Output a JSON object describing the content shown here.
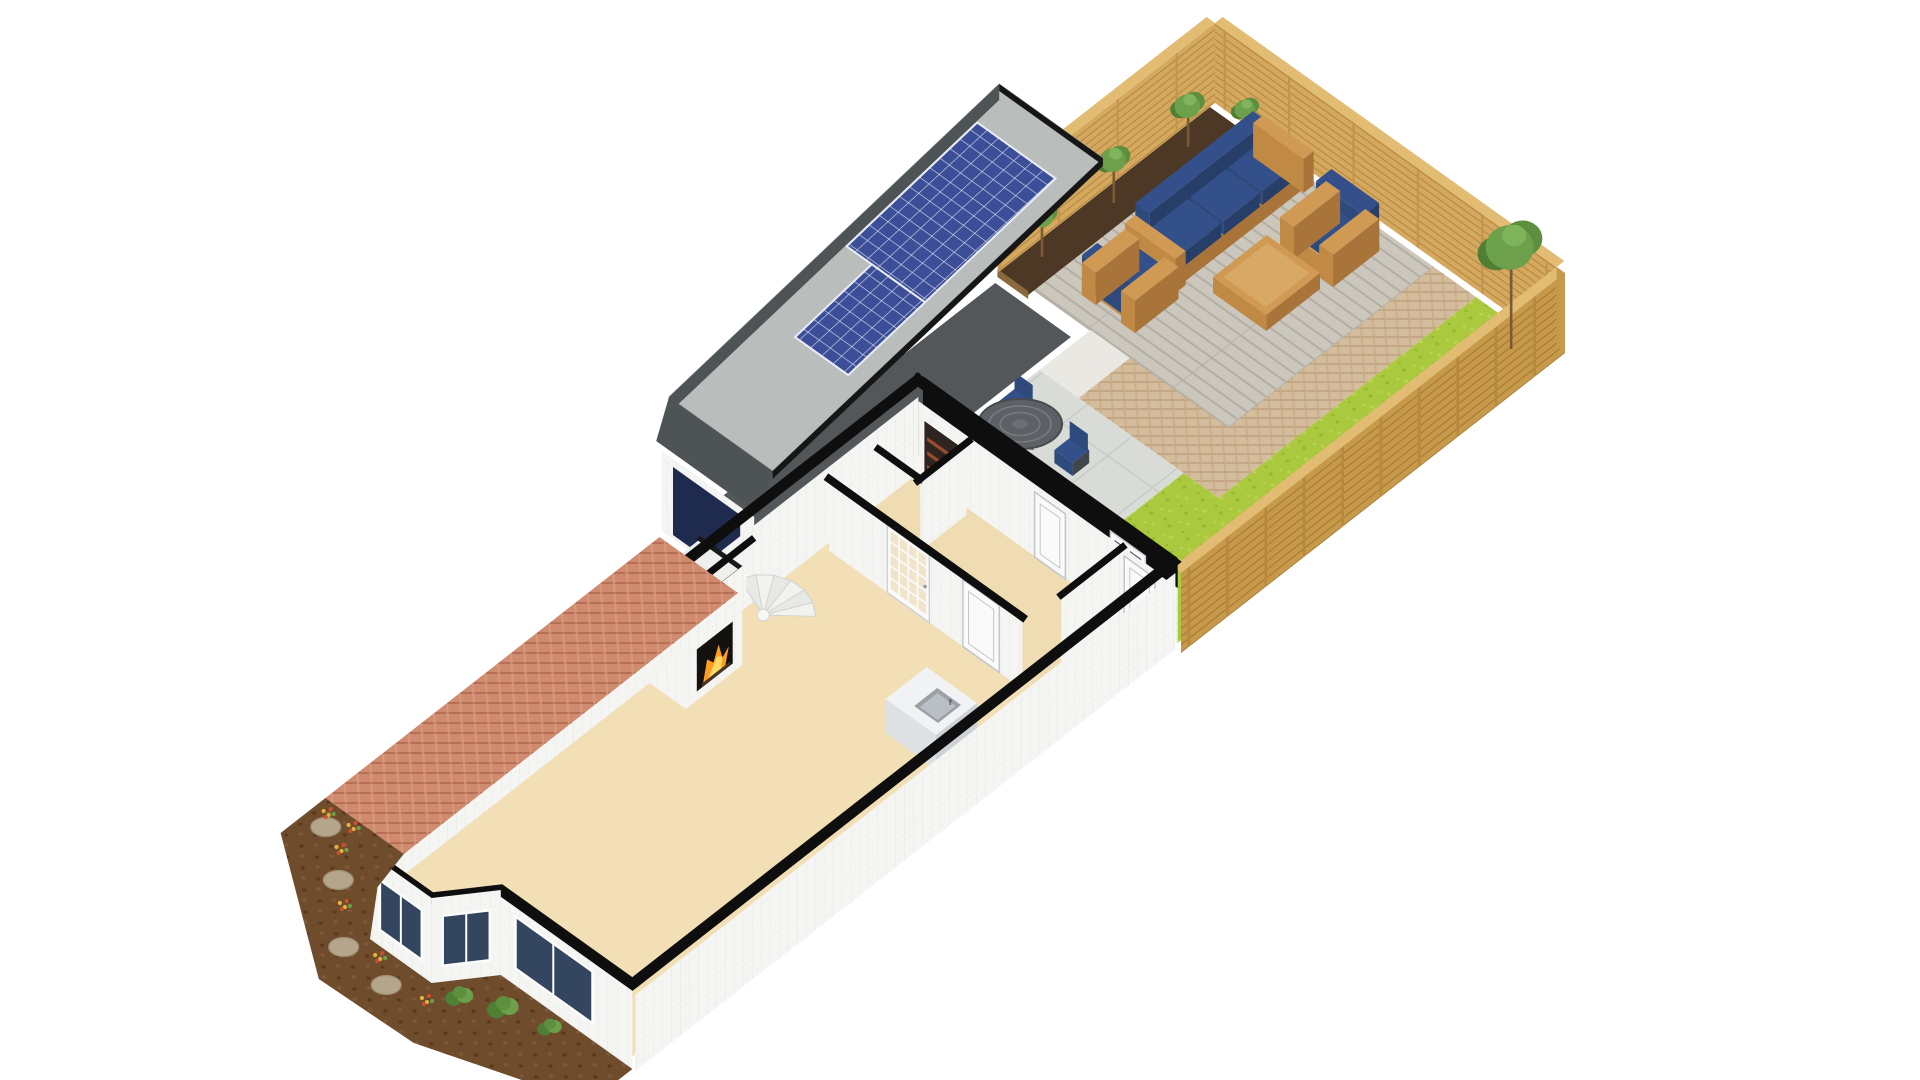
{
  "page": {
    "background": "#ffffff",
    "kind": "3d-floorplan-render"
  },
  "colors": {
    "bg": "#ffffff",
    "cutWall": "#0e0e0e",
    "wallWhite": "#f5f6f3",
    "wallShade": "#e3e6e4",
    "wallInner": "#eceeee",
    "floorBeige": "#f2dfb6",
    "floorBeigeHall": "#efdcb2",
    "garageFloor": "#54575a",
    "garageDoor": "#1e2a4e",
    "roofGrey": "#b9bdbb",
    "roofEdge": "#161616",
    "roofFascia": "#4e5356",
    "solarBlue": "#3c4e97",
    "solarLine": "#d9def0",
    "deck": "#cbc7bd",
    "deckLine": "#b2aea4",
    "pathTan": "#d4bd9d",
    "pathTanLine": "#bfa07c",
    "paveGrey": "#d9dbd7",
    "paveLine": "#c3c6c1",
    "gravel": "#e9e8e2",
    "lawn": "#abc93e",
    "lawnDot": "#97b72e",
    "lawnDot2": "#bad355",
    "soilDark": "#4c3824",
    "soilBed": "#6f4c2c",
    "soilBedDot": "#5a3a1e",
    "brick": "#d08a6e",
    "brickLine": "#b26a50",
    "woodFence": "#d4a85e",
    "woodFenceDark": "#b5873e",
    "woodFenceOuter": "#c79a4b",
    "woodFenceTop": "#e2bc72",
    "woodFurn": "#c08a45",
    "woodFurnTop": "#d09a55",
    "woodFurnDark": "#a8743a",
    "cushionNavy": "#2e4a7d",
    "cushionNavyTop": "#33508a",
    "cushionNavyDark": "#273e69",
    "treeDark": "#4f7f33",
    "treeMid": "#5d8f3f",
    "treeLight": "#6da04a",
    "trunk": "#7a5a34",
    "stone": "#b5a58a",
    "stoneEdge": "#9c8c72",
    "flowerRed": "#c9502e",
    "flowerYellow": "#e2b33c",
    "glassDark": "#34455f",
    "glassPane": "#f0e5ca",
    "metalGrey": "#5d6165",
    "metalGreyLight": "#777c80",
    "fire": "#ff9d21",
    "fireInner": "#ffd863",
    "sink": "#9aa0a5",
    "white": "#fafafa",
    "doorLine": "#c2c6c8"
  },
  "scene": {
    "areas": [
      "rear-garden",
      "patio-deck",
      "brick-path",
      "paved-patio",
      "lawn",
      "planter-bed",
      "garage",
      "driveway",
      "main-house",
      "hallway",
      "living-room",
      "kitchen",
      "front-garden-bed"
    ],
    "objects": [
      "garden-fence",
      "trees",
      "outdoor-sofa",
      "armchairs",
      "coffee-table",
      "dining-table-set",
      "solar-panel-array",
      "garage-door",
      "fireplace",
      "staircase",
      "kitchen-island",
      "glazed-door",
      "bay-window",
      "rear-door",
      "stepping-stones",
      "shrubs",
      "flower-clusters"
    ]
  }
}
